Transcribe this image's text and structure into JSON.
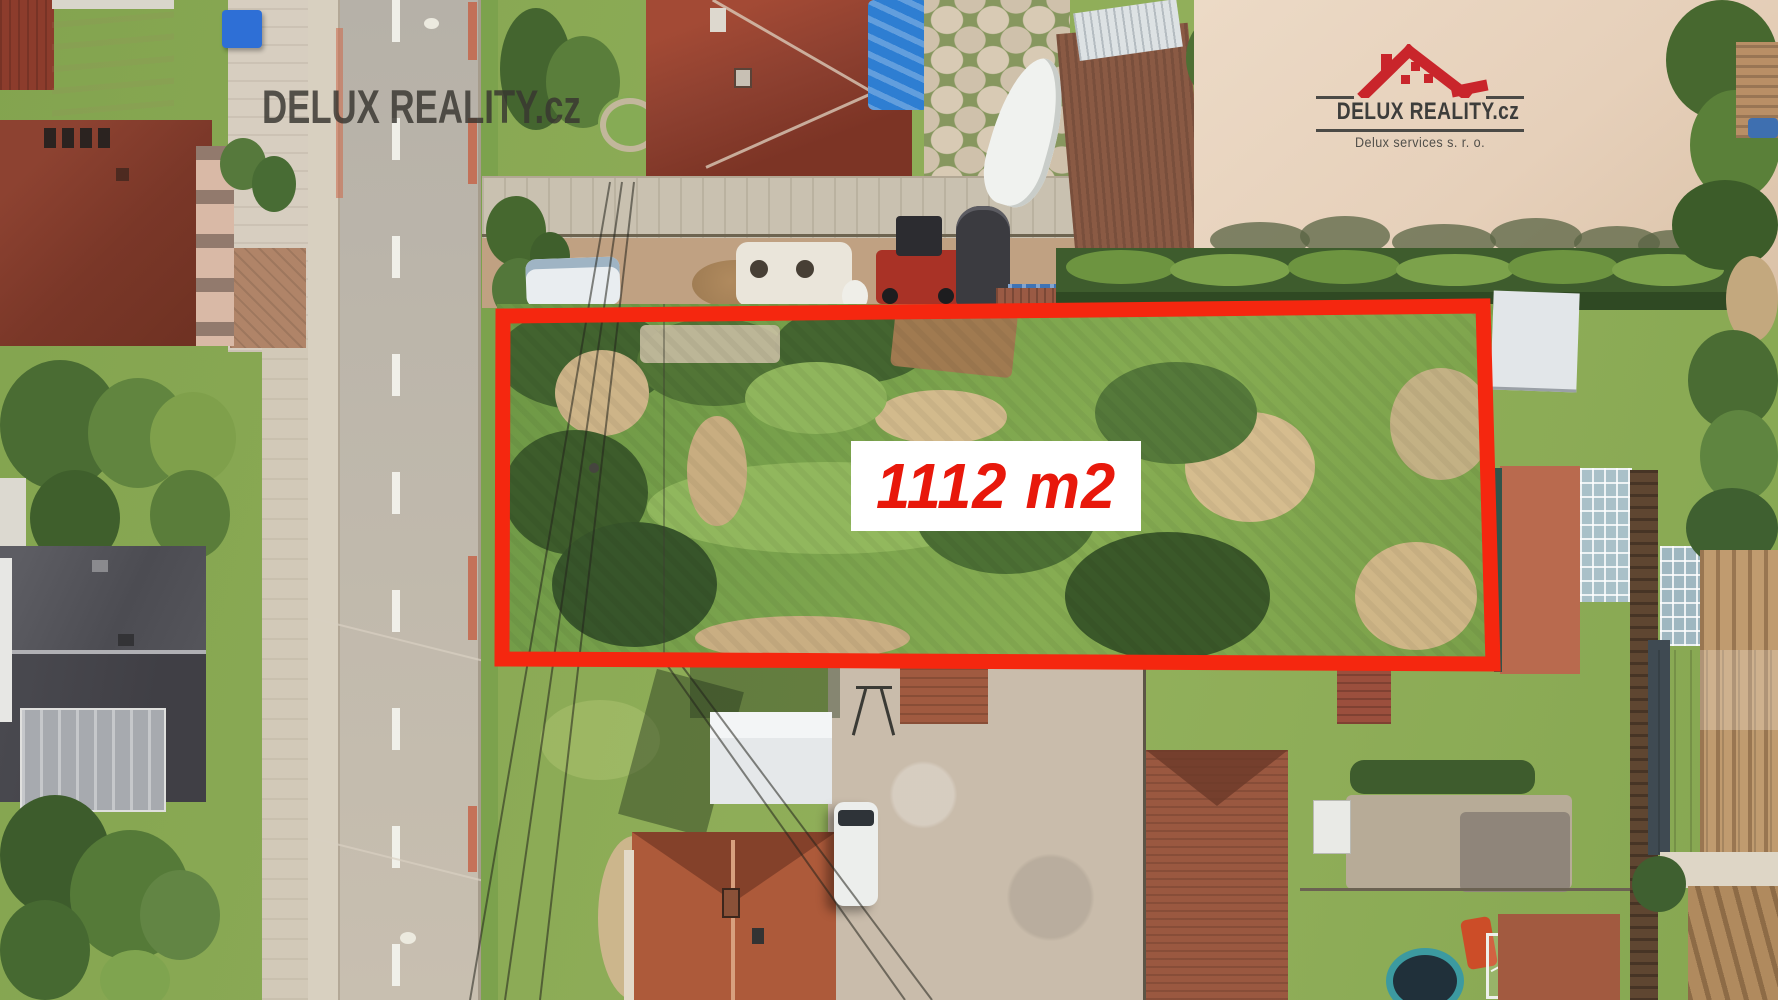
{
  "watermark": {
    "text": "DELUX REALITY.cz"
  },
  "logo": {
    "title": "DELUX REALITY.cz",
    "subtitle": "Delux services s. r. o."
  },
  "plot": {
    "area_label": "1112 m2"
  },
  "palette": {
    "outline_red": "#f5270f",
    "label_text_red": "#e8180b",
    "label_background": "#ffffff",
    "watermark_gray": "#383630",
    "logo_red": "#c9252b",
    "logo_text": "#3d3d3b",
    "road_asphalt": "#bfb8ab",
    "grass_green": "#86a751",
    "dirt_field_tan": "#e8d5c1",
    "roof_red_brown": "#9a4530",
    "bright_roof_red": "#c5392b"
  }
}
